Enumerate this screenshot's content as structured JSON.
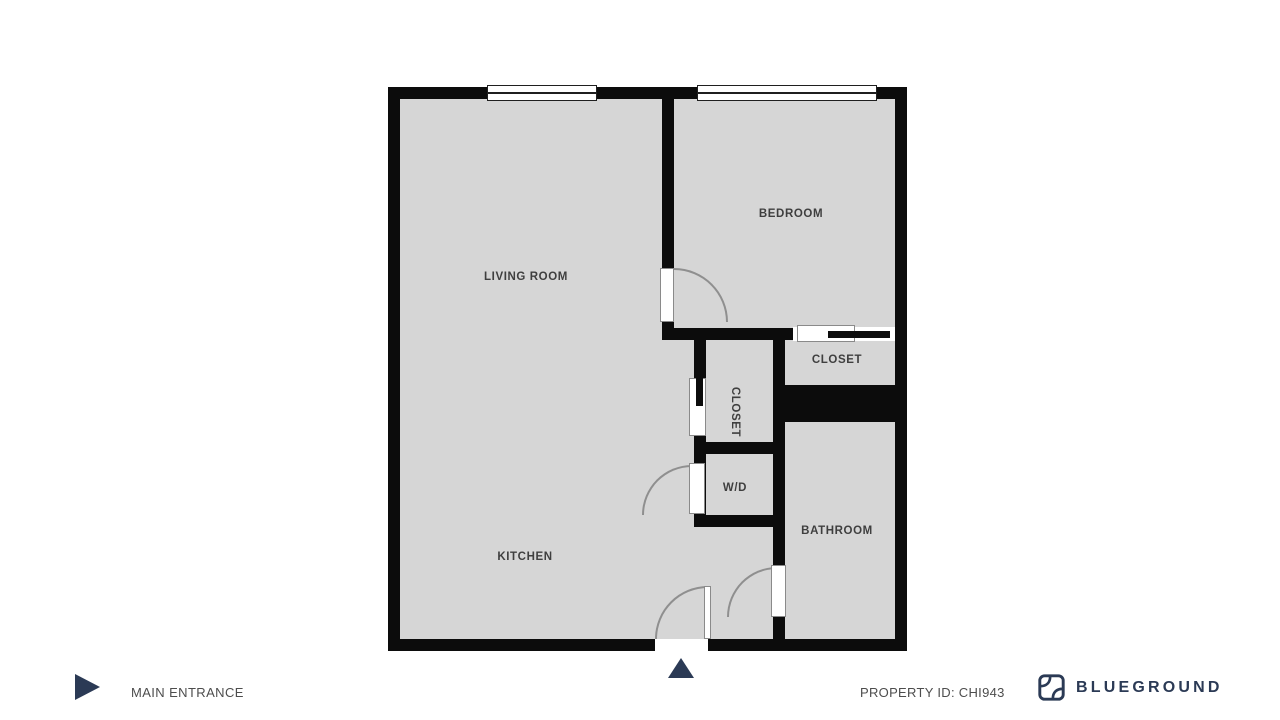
{
  "plan": {
    "rooms": {
      "living_room": "LIVING ROOM",
      "kitchen": "KITCHEN",
      "bedroom": "BEDROOM",
      "closet_right": "CLOSET",
      "closet_middle": "CLOSET",
      "wd": "W/D",
      "bathroom": "BATHROOM"
    }
  },
  "footer": {
    "entrance_label": "MAIN ENTRANCE",
    "property_id": "PROPERTY ID: CHI943",
    "brand": "BLUEGROUND"
  },
  "icons": {
    "entrance_direction": "triangle-right-icon",
    "entrance_marker": "triangle-up-icon",
    "brand_logo": "blueground-mark-icon"
  },
  "colors": {
    "wall": "#0c0c0c",
    "floor": "#d6d6d6",
    "accent_navy": "#2b3a55",
    "room_label": "#3f3f3f",
    "footer_text": "#4d4d4d"
  }
}
